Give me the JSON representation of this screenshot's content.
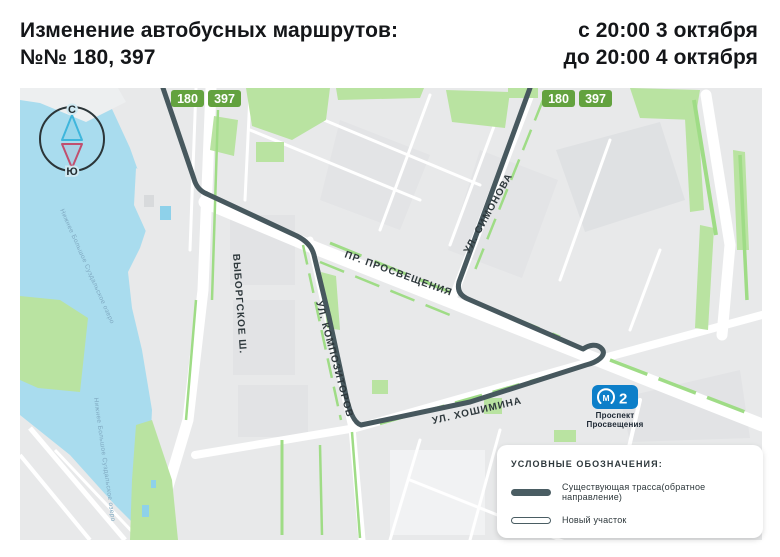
{
  "header": {
    "title_line1": "Изменение автобусных маршрутов:",
    "title_line2": "№№ 180, 397",
    "date_line1": "с 20:00 3 октября",
    "date_line2": "до 20:00 4 октября"
  },
  "badges": {
    "left": [
      {
        "label": "180"
      },
      {
        "label": "397"
      }
    ],
    "right": [
      {
        "label": "180"
      },
      {
        "label": "397"
      }
    ]
  },
  "streets": {
    "vyborgskoe": "ВЫБОРГСКОЕ Ш.",
    "kompozitorov": "УЛ. КОМПОЗИТОРОВ",
    "prosveshcheniya": "ПР. ПРОСВЕЩЕНИЯ",
    "simonova": "УЛ. СИМОНОВА",
    "khoshimina": "УЛ. ХОШИМИНА"
  },
  "water": {
    "label": "Нижнее Большое Суздальское озеро"
  },
  "compass": {
    "north": "С",
    "south": "Ю"
  },
  "metro": {
    "logo_letter": "М",
    "line_number": "2",
    "station_line1": "Проспект",
    "station_line2": "Просвещения"
  },
  "legend": {
    "title": "УСЛОВНЫЕ ОБОЗНАЧЕНИЯ:",
    "existing_label": "Существующая трасса(обратное направление)",
    "new_label": "Новый участок"
  },
  "colors": {
    "route": "#47585e",
    "badge_green": "#63a23f",
    "water": "#a9dcee",
    "park": "#b9e3a1",
    "metro_blue": "#0d7fc9",
    "compass_north": "#3fb6dc",
    "compass_south": "#c14f6e",
    "legend_line": "#4a5d63"
  }
}
